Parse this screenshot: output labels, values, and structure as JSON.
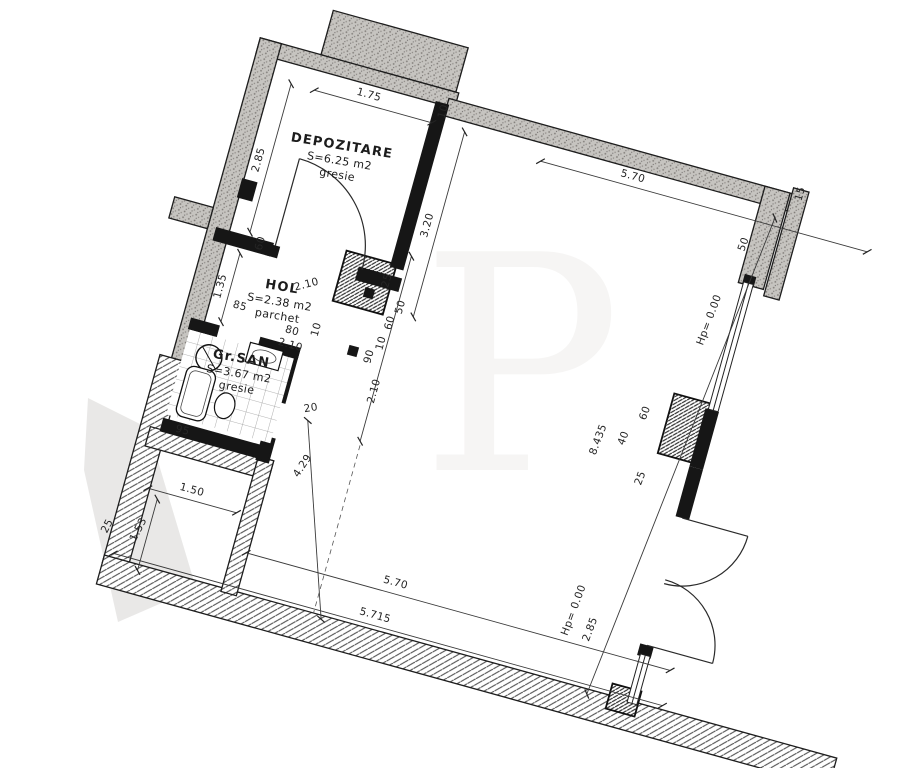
{
  "watermark": "P",
  "colors": {
    "ink": "#262626",
    "wall_black": "#161616",
    "wall_gray": "#c6c4c0",
    "paper": "#ffffff"
  },
  "rooms": [
    {
      "name": "DEPOZITARE",
      "area": "S=6.25 m2",
      "floor": "gresie",
      "x": 100,
      "y": 86,
      "r": -6
    },
    {
      "name": "HOL",
      "area": "S=2.38 m2",
      "floor": "parchet",
      "x": 80,
      "y": 238,
      "r": -6
    },
    {
      "name": "Gr.SAN",
      "area": "S=3.67 m2",
      "floor": "gresie",
      "x": 60,
      "y": 318,
      "r": -6
    }
  ],
  "dims": [
    {
      "t": "1.75",
      "l": [
        58,
        36,
        180,
        36
      ],
      "p": [
        112,
        29
      ],
      "r": 0
    },
    {
      "t": "2.85",
      "l": [
        34,
        36,
        34,
        190
      ],
      "p": [
        26,
        118
      ],
      "r": -90
    },
    {
      "t": "10",
      "p": [
        191,
        22
      ],
      "r": -90
    },
    {
      "t": "3.20",
      "l": [
        214,
        36,
        214,
        228
      ],
      "p": [
        206,
        136
      ],
      "r": -90
    },
    {
      "t": "5.70",
      "l": [
        295,
        44,
        634,
        44
      ],
      "p": [
        388,
        37
      ],
      "r": 0
    },
    {
      "t": "50",
      "p": [
        516,
        70
      ],
      "r": -85
    },
    {
      "t": "15",
      "p": [
        557,
        6
      ],
      "r": -90
    },
    {
      "t": "25",
      "p": [
        182,
        200
      ],
      "r": -90
    },
    {
      "t": "50",
      "p": [
        202,
        222
      ],
      "r": -90
    },
    {
      "t": "60",
      "p": [
        196,
        240
      ],
      "r": -90
    },
    {
      "t": "10",
      "p": [
        193,
        262
      ],
      "r": -90
    },
    {
      "t": "90",
      "p": [
        185,
        278
      ],
      "r": -90
    },
    {
      "t": "2.10",
      "l": [
        196,
        170,
        196,
        362
      ],
      "p": [
        199,
        310
      ],
      "r": -90
    },
    {
      "t": "60",
      "p": [
        50,
        198
      ],
      "r": -90
    },
    {
      "t": "2.10",
      "p": [
        104,
        228
      ],
      "r": -30
    },
    {
      "t": "1.35",
      "l": [
        30,
        213,
        30,
        284
      ],
      "p": [
        23,
        250
      ],
      "r": -90
    },
    {
      "t": "85",
      "p": [
        44,
        267
      ],
      "r": 0
    },
    {
      "t": "80",
      "p": [
        101,
        277
      ],
      "r": 0
    },
    {
      "t": "2.10",
      "p": [
        103,
        291
      ],
      "r": 0
    },
    {
      "t": "10",
      "p": [
        127,
        266
      ],
      "r": -90
    },
    {
      "t": "20",
      "p": [
        141,
        346
      ],
      "r": -25
    },
    {
      "t": "4.29",
      "l": [
        140,
        356,
        206,
        544
      ],
      "p": [
        150,
        402
      ],
      "r": -72
    },
    {
      "t": "95",
      "p": [
        22,
        402
      ],
      "r": 0
    },
    {
      "t": "1.50",
      "l": [
        4,
        464,
        96,
        464
      ],
      "p": [
        47,
        457
      ],
      "r": 0
    },
    {
      "t": "1.53",
      "l": [
        16,
        472,
        16,
        546
      ],
      "p": [
        9,
        507
      ],
      "r": -78
    },
    {
      "t": "25",
      "p": [
        -22,
        512
      ],
      "r": -78
    },
    {
      "t": "5.70",
      "l": [
        116,
        500,
        556,
        500
      ],
      "p": [
        268,
        492
      ],
      "r": 0
    },
    {
      "t": "5.715",
      "l": [
        -12,
        536,
        558,
        536
      ],
      "p": [
        257,
        529
      ],
      "r": 0
    },
    {
      "t": "2.85",
      "p": [
        471,
        482
      ],
      "r": -85
    },
    {
      "t": "Hp= 0.00",
      "p": [
        450,
        468
      ],
      "r": -85
    },
    {
      "t": "Hp= 0.00",
      "p": [
        503,
        152
      ],
      "r": -85
    },
    {
      "t": "8.435",
      "l": [
        536,
        36,
        482,
        545
      ],
      "p": [
        428,
        297
      ],
      "r": -85
    },
    {
      "t": "40",
      "p": [
        452,
        289
      ],
      "r": -85
    },
    {
      "t": "60",
      "p": [
        466,
        259
      ],
      "r": -85
    },
    {
      "t": "25",
      "p": [
        479,
        323
      ],
      "r": -85
    }
  ]
}
